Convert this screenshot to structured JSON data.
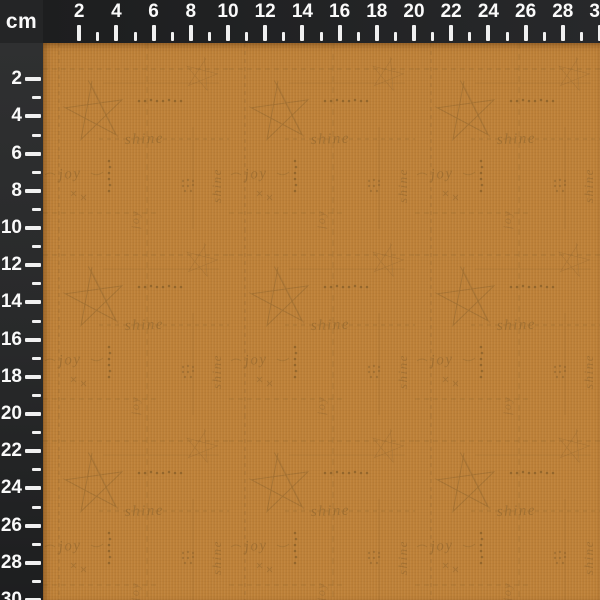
{
  "corner": {
    "unit_label": "cm"
  },
  "ruler": {
    "labels": [
      2,
      4,
      6,
      8,
      10,
      12,
      14,
      16,
      18,
      20,
      22,
      24,
      26,
      28,
      30
    ],
    "minor_ticks": [
      3,
      5,
      7,
      9,
      11,
      13,
      15,
      17,
      19,
      21,
      23,
      25,
      27,
      29
    ],
    "max_cm": 30
  },
  "fabric": {
    "words": [
      "shine",
      "joy",
      "shine",
      "joy"
    ],
    "motifs": [
      "sketched-star",
      "dashed-grid-line",
      "stitch-dot-row",
      "cross-stitch"
    ]
  },
  "colors": {
    "ruler_dark": "#1d1e1f",
    "ruler_light": "#2f3031",
    "corner_bg": "#242526",
    "tick": "#f0f0f0",
    "number": "#fafafa",
    "fabric_base": "#bf8239",
    "fabric_print": "#8c6129"
  }
}
